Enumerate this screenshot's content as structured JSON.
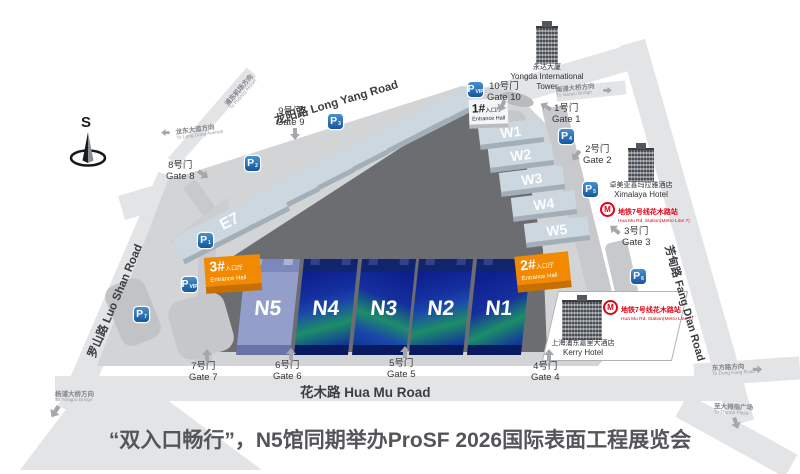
{
  "title": "“双入口畅行”，N5馆同期举办ProSF 2026国际表面工程展览会",
  "compass": {
    "south_label": "S"
  },
  "roads": {
    "long_yang": "龙阳路 Long Yang Road",
    "luo_shan": "罗山路 Luo Shan Road",
    "hua_mu": "花木路 Hua Mu Road",
    "fang_dian": "芳甸路 Fang Dian Road"
  },
  "halls": {
    "east": [
      "E1",
      "E2",
      "E3",
      "E4",
      "E5",
      "E6",
      "E7"
    ],
    "west": [
      "W1",
      "W2",
      "W3",
      "W4",
      "W5"
    ],
    "north": [
      "N1",
      "N2",
      "N3",
      "N4",
      "N5"
    ]
  },
  "entrances": [
    {
      "num": "1#",
      "cn": "入口厅",
      "en": "Entrance Hall"
    },
    {
      "num": "2#",
      "cn": "入口厅",
      "en": "Entrance Hall"
    },
    {
      "num": "3#",
      "cn": "入口厅",
      "en": "Entrance Hall"
    }
  ],
  "gates": [
    {
      "cn": "1号门",
      "en": "Gate 1"
    },
    {
      "cn": "2号门",
      "en": "Gate 2"
    },
    {
      "cn": "3号门",
      "en": "Gate 3"
    },
    {
      "cn": "4号门",
      "en": "Gate 4"
    },
    {
      "cn": "5号门",
      "en": "Gate 5"
    },
    {
      "cn": "6号门",
      "en": "Gate 6"
    },
    {
      "cn": "7号门",
      "en": "Gate 7"
    },
    {
      "cn": "8号门",
      "en": "Gate 8"
    },
    {
      "cn": "9号门",
      "en": "Gate 9"
    },
    {
      "cn": "10号门",
      "en": "Gate 10"
    }
  ],
  "parking": {
    "letter": "P",
    "lots": [
      "1",
      "2",
      "3",
      "4",
      "5",
      "6",
      "7",
      "VIP"
    ]
  },
  "metro": {
    "cn": "地铁7号线花木路站",
    "en": "Hua Mu Rd. Station(Metro Line 7)"
  },
  "buildings": [
    {
      "cn": "永达大厦",
      "en": "Yongda International Tower"
    },
    {
      "cn": "卓美亚喜玛拉雅酒店",
      "en": "Ximalaya Hotel"
    },
    {
      "cn": "上海浦东嘉里大酒店",
      "en": "Kerry Hotel"
    }
  ],
  "directions": [
    {
      "cn": "浦东机场方向",
      "en": "To Pudong Airport"
    },
    {
      "cn": "龙东大道方向",
      "en": "To Long Dong Avenue"
    },
    {
      "cn": "南浦大桥方向",
      "en": "To Nanpu Bridge"
    },
    {
      "cn": "杨浦大桥方向",
      "en": "To Yangpu Bridge"
    },
    {
      "cn": "东方路方向",
      "en": "To Dong Fang Road"
    },
    {
      "cn": "至大拇指广场",
      "en": "To Thumb Plaza"
    }
  ],
  "colors": {
    "hall_dark_blue": "#13288f",
    "hall_green_accent": "#1d8e68",
    "hall_n5_blue": "#939ecb",
    "entrance_orange": "#f18a00",
    "parking_blue": "#15589d",
    "metro_red": "#e60012",
    "road_gray": "#e3e4e6",
    "yard_gray": "#6c6d70"
  }
}
